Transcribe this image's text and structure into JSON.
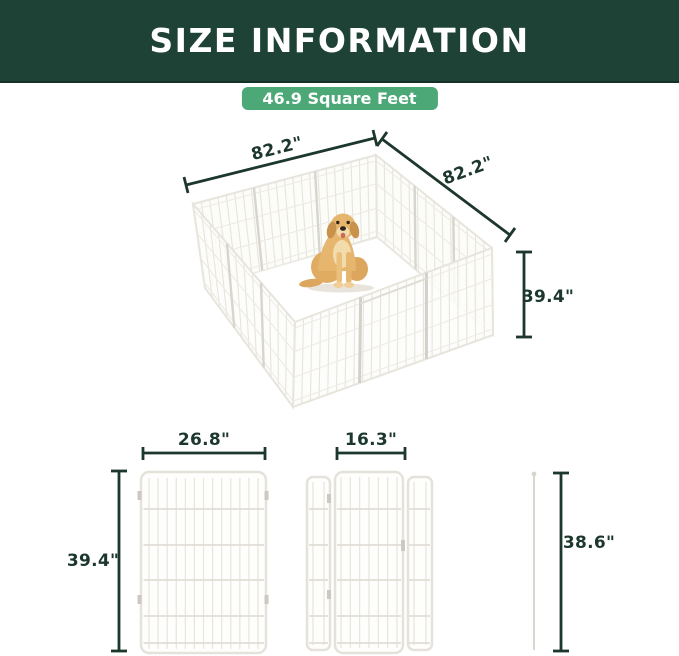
{
  "header": {
    "title": "SIZE INFORMATION"
  },
  "badge": {
    "label": "46.9 Square Feet"
  },
  "pen": {
    "dim_left": "82.2\"",
    "dim_right": "82.2\"",
    "dim_height": "39.4\""
  },
  "panel_views": {
    "regular_panel": {
      "width": "26.8\"",
      "height": "39.4\""
    },
    "door_panel": {
      "width": "16.3\""
    },
    "ground_stake": {
      "height": "38.6\""
    }
  },
  "colors": {
    "header_bg": "#1E4235",
    "badge_green": "#4DA877",
    "dim_ink": "#1C372C",
    "fence_line": "#E4E2DA"
  }
}
